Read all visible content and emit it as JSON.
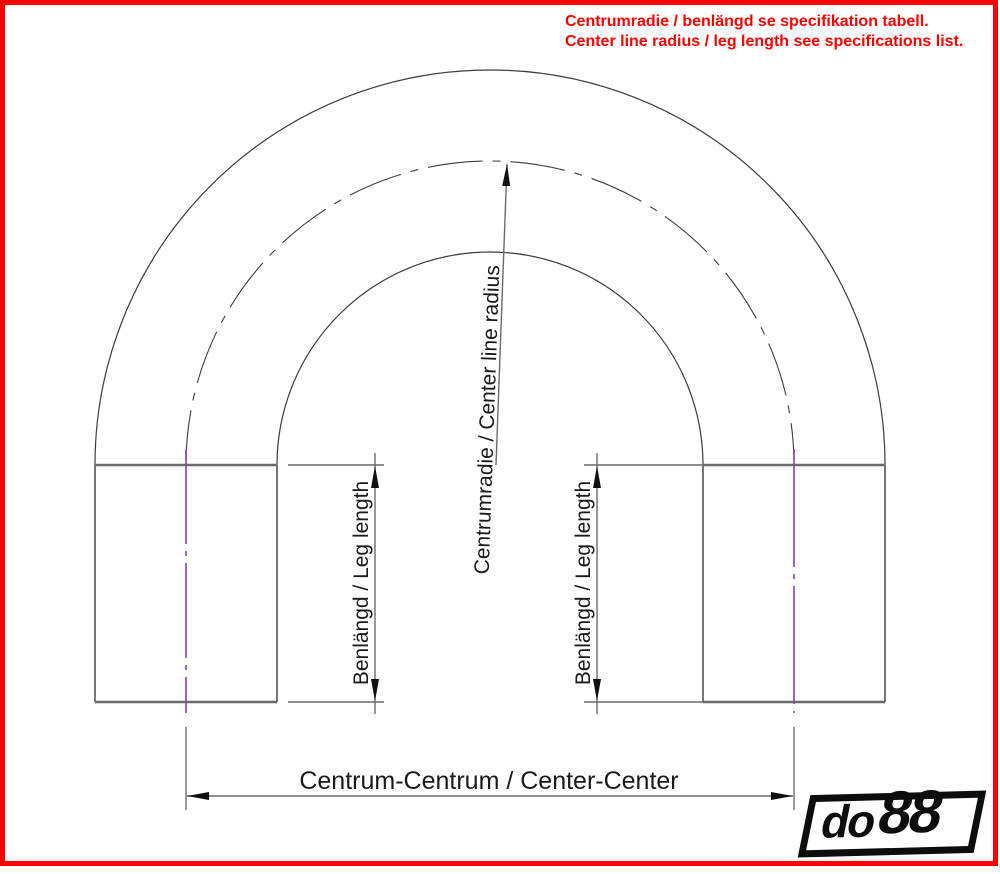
{
  "notice": {
    "line1": "Centrumradie / benlängd se specifikation tabell.",
    "line2": "Center line radius / leg length see specifications list.",
    "color": "#ff0000"
  },
  "diagram": {
    "labels": {
      "radius": "Centrumradie / Center line radius",
      "leg_left": "Benlängd / Leg length",
      "leg_right": "Benlängd / Leg length",
      "center_center": "Centrum-Centrum / Center-Center"
    },
    "colors": {
      "outline": "#3d3d3d",
      "dimension": "#6b6b6b",
      "centerline": "#8a42ad",
      "frame": "#ff0000",
      "arrow": "#111111"
    }
  },
  "logo": {
    "part1": "do",
    "part2": "88"
  }
}
